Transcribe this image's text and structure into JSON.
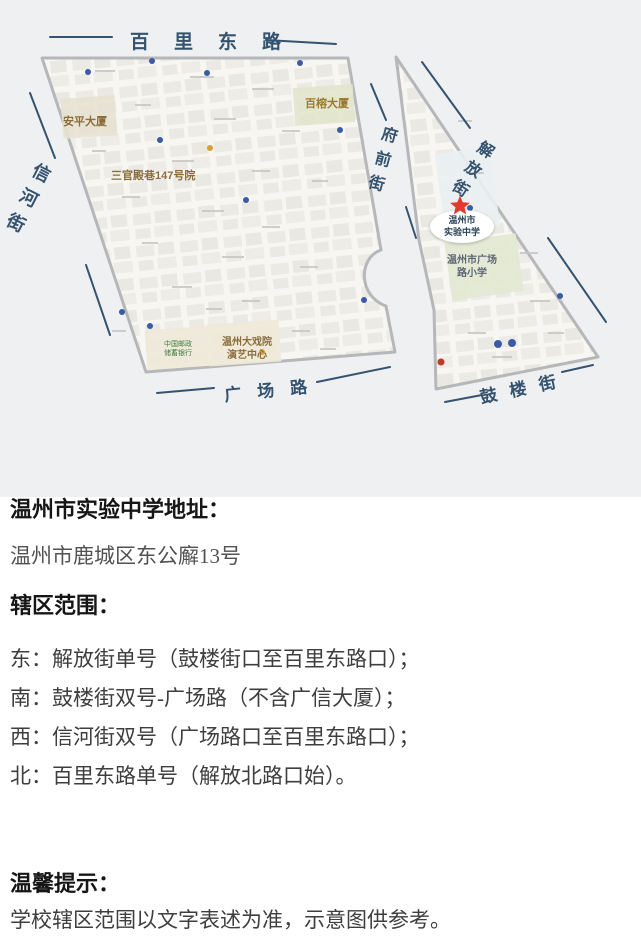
{
  "map": {
    "street_labels": {
      "bailidong_road": "百里东路",
      "xinhe_street": "信河街",
      "fuqian_street": "府前街",
      "jiefang_street": "解放街",
      "guangchang_road": "广场路",
      "gulou_street": "鼓楼街"
    },
    "pois": {
      "anping_building": "安平大厦",
      "sanguandian_alley": "三官殿巷147号院",
      "bairong_building": "百榕大厦",
      "theater_line1": "温州大戏院",
      "theater_line2": "演艺中心",
      "postal_bank_line1": "中国邮政",
      "postal_bank_line2": "储蓄银行",
      "school_line1": "温州市",
      "school_line2": "实验中学",
      "primary_school_line1": "温州市广场",
      "primary_school_line2": "路小学"
    },
    "marker": "red-star"
  },
  "content": {
    "address_heading": "温州市实验中学地址：",
    "address": "温州市鹿城区东公廨13号",
    "scope_heading": "辖区范围：",
    "boundaries": [
      "东：解放街单号（鼓楼街口至百里东路口）；",
      "南：鼓楼街双号-广场路（不含广信大厦）；",
      "西：信河街双号（广场路口至百里东路口）；",
      "北：百里东路单号（解放北路口始）。"
    ],
    "tip_heading": "温馨提示：",
    "tip": "学校辖区范围以文字表述为准，示意图供参考。"
  },
  "colors": {
    "street_label": "#35536f",
    "map_background": "#eff0f2",
    "district_fill": "#f7f6f2",
    "district_border": "#b5b7b9",
    "poi_brown": "#8a6d3b",
    "bank_green": "#3f7d3f",
    "star_red": "#e23b2e"
  }
}
